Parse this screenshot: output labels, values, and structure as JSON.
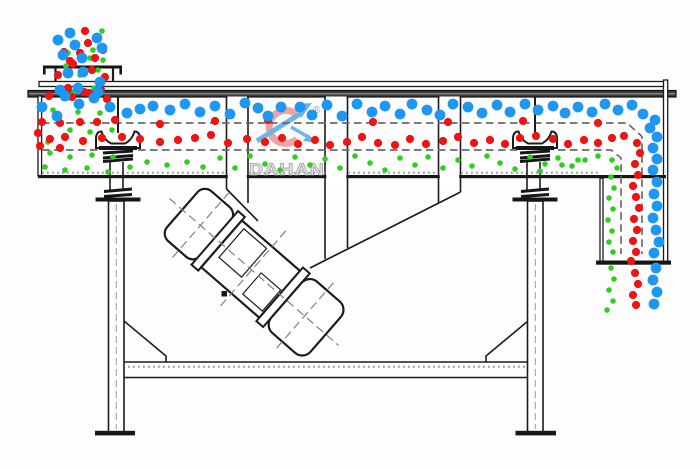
{
  "diagram": {
    "type": "linear-vibrating-screen-working-principle",
    "watermark": {
      "brand": "DAHAN",
      "registered_mark": "®"
    },
    "colors": {
      "blue": "#1e97f2",
      "red": "#ee1414",
      "green": "#2ecf1d",
      "outline": "#1c1c1c",
      "mesh_dash": "#6b6b6b",
      "watermark_crescent": "#e4726b",
      "watermark_swoosh": "#58a7e6",
      "watermark_text_fill": "#e2e2e2"
    },
    "particle_radius": {
      "blue": 5.4,
      "red": 4.1,
      "green": 2.8
    },
    "particles": {
      "blue": [
        [
          70,
          33
        ],
        [
          58,
          40
        ],
        [
          75,
          45
        ],
        [
          97,
          38
        ],
        [
          102,
          48
        ],
        [
          63,
          55
        ],
        [
          82,
          58
        ],
        [
          83,
          72
        ],
        [
          68,
          73
        ],
        [
          100,
          82
        ],
        [
          60,
          90
        ],
        [
          78,
          88
        ],
        [
          98,
          92
        ],
        [
          42,
          107
        ],
        [
          57,
          116
        ],
        [
          65,
          96
        ],
        [
          79,
          104
        ],
        [
          94,
          98
        ],
        [
          110,
          107
        ],
        [
          127,
          113
        ],
        [
          140,
          109
        ],
        [
          153,
          106
        ],
        [
          170,
          110
        ],
        [
          185,
          104
        ],
        [
          200,
          112
        ],
        [
          215,
          106
        ],
        [
          230,
          114
        ],
        [
          245,
          103
        ],
        [
          258,
          108
        ],
        [
          268,
          116
        ],
        [
          281,
          107
        ],
        [
          300,
          107
        ],
        [
          312,
          115
        ],
        [
          327,
          105
        ],
        [
          342,
          116
        ],
        [
          357,
          104
        ],
        [
          372,
          112
        ],
        [
          385,
          106
        ],
        [
          400,
          114
        ],
        [
          412,
          104
        ],
        [
          427,
          110
        ],
        [
          440,
          115
        ],
        [
          453,
          104
        ],
        [
          468,
          107
        ],
        [
          482,
          113
        ],
        [
          497,
          105
        ],
        [
          510,
          112
        ],
        [
          525,
          104
        ],
        [
          538,
          110
        ],
        [
          553,
          106
        ],
        [
          565,
          113
        ],
        [
          578,
          107
        ],
        [
          592,
          112
        ],
        [
          605,
          104
        ],
        [
          618,
          110
        ],
        [
          632,
          105
        ],
        [
          643,
          114
        ],
        [
          655,
          120
        ],
        [
          650,
          128
        ],
        [
          657,
          137
        ],
        [
          653,
          148
        ],
        [
          657,
          159
        ],
        [
          653,
          170
        ],
        [
          657,
          182
        ],
        [
          654,
          194
        ],
        [
          657,
          206
        ],
        [
          653,
          218
        ],
        [
          656,
          230
        ],
        [
          659,
          242
        ],
        [
          654,
          253
        ],
        [
          656,
          268
        ],
        [
          653,
          280
        ],
        [
          657,
          292
        ],
        [
          654,
          304
        ]
      ],
      "red": [
        [
          85,
          31
        ],
        [
          88,
          43
        ],
        [
          80,
          53
        ],
        [
          95,
          58
        ],
        [
          70,
          61
        ],
        [
          103,
          50
        ],
        [
          64,
          52
        ],
        [
          92,
          70
        ],
        [
          73,
          64
        ],
        [
          105,
          77
        ],
        [
          58,
          75
        ],
        [
          84,
          92
        ],
        [
          101,
          90
        ],
        [
          68,
          88
        ],
        [
          49,
          96
        ],
        [
          72,
          97
        ],
        [
          89,
          93
        ],
        [
          107,
          99
        ],
        [
          42,
          122
        ],
        [
          60,
          123
        ],
        [
          80,
          122
        ],
        [
          97,
          122
        ],
        [
          115,
          120
        ],
        [
          160,
          124
        ],
        [
          215,
          121
        ],
        [
          268,
          120
        ],
        [
          373,
          122
        ],
        [
          448,
          122
        ],
        [
          523,
          121
        ],
        [
          598,
          123
        ],
        [
          38,
          133
        ],
        [
          50,
          139
        ],
        [
          65,
          137
        ],
        [
          83,
          141
        ],
        [
          102,
          138
        ],
        [
          122,
          137
        ],
        [
          140,
          139
        ],
        [
          160,
          142
        ],
        [
          178,
          140
        ],
        [
          195,
          138
        ],
        [
          211,
          135
        ],
        [
          228,
          143
        ],
        [
          247,
          139
        ],
        [
          265,
          142
        ],
        [
          282,
          138
        ],
        [
          298,
          144
        ],
        [
          315,
          140
        ],
        [
          330,
          145
        ],
        [
          347,
          142
        ],
        [
          362,
          137
        ],
        [
          378,
          143
        ],
        [
          395,
          145
        ],
        [
          410,
          139
        ],
        [
          426,
          144
        ],
        [
          443,
          141
        ],
        [
          458,
          137
        ],
        [
          474,
          143
        ],
        [
          490,
          140
        ],
        [
          505,
          144
        ],
        [
          520,
          138
        ],
        [
          536,
          136
        ],
        [
          553,
          139
        ],
        [
          568,
          144
        ],
        [
          584,
          140
        ],
        [
          598,
          143
        ],
        [
          612,
          138
        ],
        [
          40,
          146
        ],
        [
          60,
          148
        ],
        [
          624,
          136
        ],
        [
          637,
          143
        ],
        [
          640,
          153
        ],
        [
          635,
          164
        ],
        [
          638,
          175
        ],
        [
          633,
          186
        ],
        [
          636,
          197
        ],
        [
          639,
          208
        ],
        [
          634,
          219
        ],
        [
          637,
          230
        ],
        [
          633,
          241
        ],
        [
          636,
          252
        ],
        [
          631,
          261
        ],
        [
          635,
          273
        ],
        [
          638,
          284
        ],
        [
          633,
          295
        ],
        [
          636,
          305
        ]
      ],
      "green": [
        [
          102,
          31
        ],
        [
          103,
          46
        ],
        [
          68,
          53
        ],
        [
          93,
          50
        ],
        [
          90,
          58
        ],
        [
          66,
          66
        ],
        [
          80,
          75
        ],
        [
          98,
          70
        ],
        [
          73,
          93
        ],
        [
          94,
          88
        ],
        [
          103,
          60
        ],
        [
          53,
          110
        ],
        [
          78,
          112
        ],
        [
          100,
          113
        ],
        [
          70,
          130
        ],
        [
          90,
          132
        ],
        [
          112,
          130
        ],
        [
          48,
          142
        ],
        [
          50,
          153
        ],
        [
          70,
          157
        ],
        [
          92,
          155
        ],
        [
          113,
          157
        ],
        [
          45,
          167
        ],
        [
          65,
          170
        ],
        [
          87,
          168
        ],
        [
          108,
          172
        ],
        [
          130,
          167
        ],
        [
          147,
          162
        ],
        [
          167,
          165
        ],
        [
          187,
          162
        ],
        [
          203,
          167
        ],
        [
          220,
          158
        ],
        [
          235,
          168
        ],
        [
          250,
          156
        ],
        [
          265,
          164
        ],
        [
          280,
          170
        ],
        [
          295,
          157
        ],
        [
          310,
          165
        ],
        [
          325,
          159
        ],
        [
          340,
          168
        ],
        [
          355,
          156
        ],
        [
          370,
          163
        ],
        [
          385,
          170
        ],
        [
          400,
          158
        ],
        [
          415,
          165
        ],
        [
          428,
          157
        ],
        [
          443,
          168
        ],
        [
          458,
          160
        ],
        [
          472,
          166
        ],
        [
          487,
          156
        ],
        [
          500,
          163
        ],
        [
          515,
          169
        ],
        [
          530,
          157
        ],
        [
          545,
          164
        ],
        [
          558,
          158
        ],
        [
          572,
          166
        ],
        [
          585,
          160
        ],
        [
          598,
          156
        ],
        [
          540,
          171
        ],
        [
          562,
          165
        ],
        [
          578,
          160
        ],
        [
          612,
          160
        ],
        [
          617,
          168
        ],
        [
          611,
          177
        ],
        [
          614,
          188
        ],
        [
          609,
          198
        ],
        [
          613,
          209
        ],
        [
          608,
          220
        ],
        [
          612,
          231
        ],
        [
          609,
          242
        ],
        [
          613,
          252
        ],
        [
          611,
          268
        ],
        [
          614,
          279
        ],
        [
          609,
          290
        ],
        [
          613,
          301
        ],
        [
          607,
          310
        ]
      ]
    }
  }
}
